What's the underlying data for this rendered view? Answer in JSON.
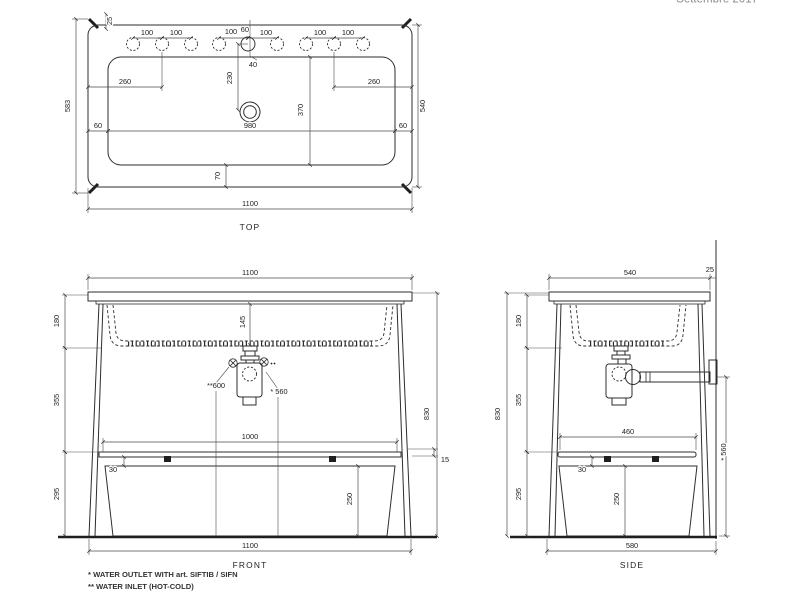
{
  "header": {
    "date": "Settembre 2017"
  },
  "views": {
    "top": {
      "label": "TOP",
      "overall_width": "1100",
      "overall_depth": "583",
      "body_depth": "540",
      "corner_tab": "25",
      "hole_spacings": [
        "100",
        "100",
        "100",
        "100",
        "100",
        "100"
      ],
      "hole_back_offset": "60",
      "hole_to_rim": "40",
      "hole_to_drain": "230",
      "hole_group_offsets": [
        "260",
        "260"
      ],
      "rim_side_gaps": [
        "60",
        "60"
      ],
      "basin_width": "980",
      "basin_depth": "370",
      "basin_front_gap": "70"
    },
    "front": {
      "label": "FRONT",
      "top_width": "1100",
      "basin_inner_depth": "145",
      "seg_top": "180",
      "seg_middle": "355",
      "seg_bottom": "295",
      "overall_height": "830",
      "inlet_height": "**600",
      "outlet_height": "* 560",
      "shelf_width": "1000",
      "shelf_gap": "30",
      "rail_size": "15",
      "panel_height": "250",
      "bottom_width": "1100"
    },
    "side": {
      "label": "SIDE",
      "top_depth": "540",
      "wall_gap": "25",
      "seg_top": "180",
      "seg_middle": "355",
      "seg_bottom": "295",
      "overall_height": "830",
      "outlet_height": "* 560",
      "shelf_depth": "460",
      "shelf_gap": "30",
      "panel_height": "250",
      "bottom_width": "580"
    }
  },
  "footnotes": {
    "outlet": "* WATER OUTLET WITH art. SIFTIB / SIFN",
    "inlet": "** WATER INLET (HOT-COLD)"
  }
}
